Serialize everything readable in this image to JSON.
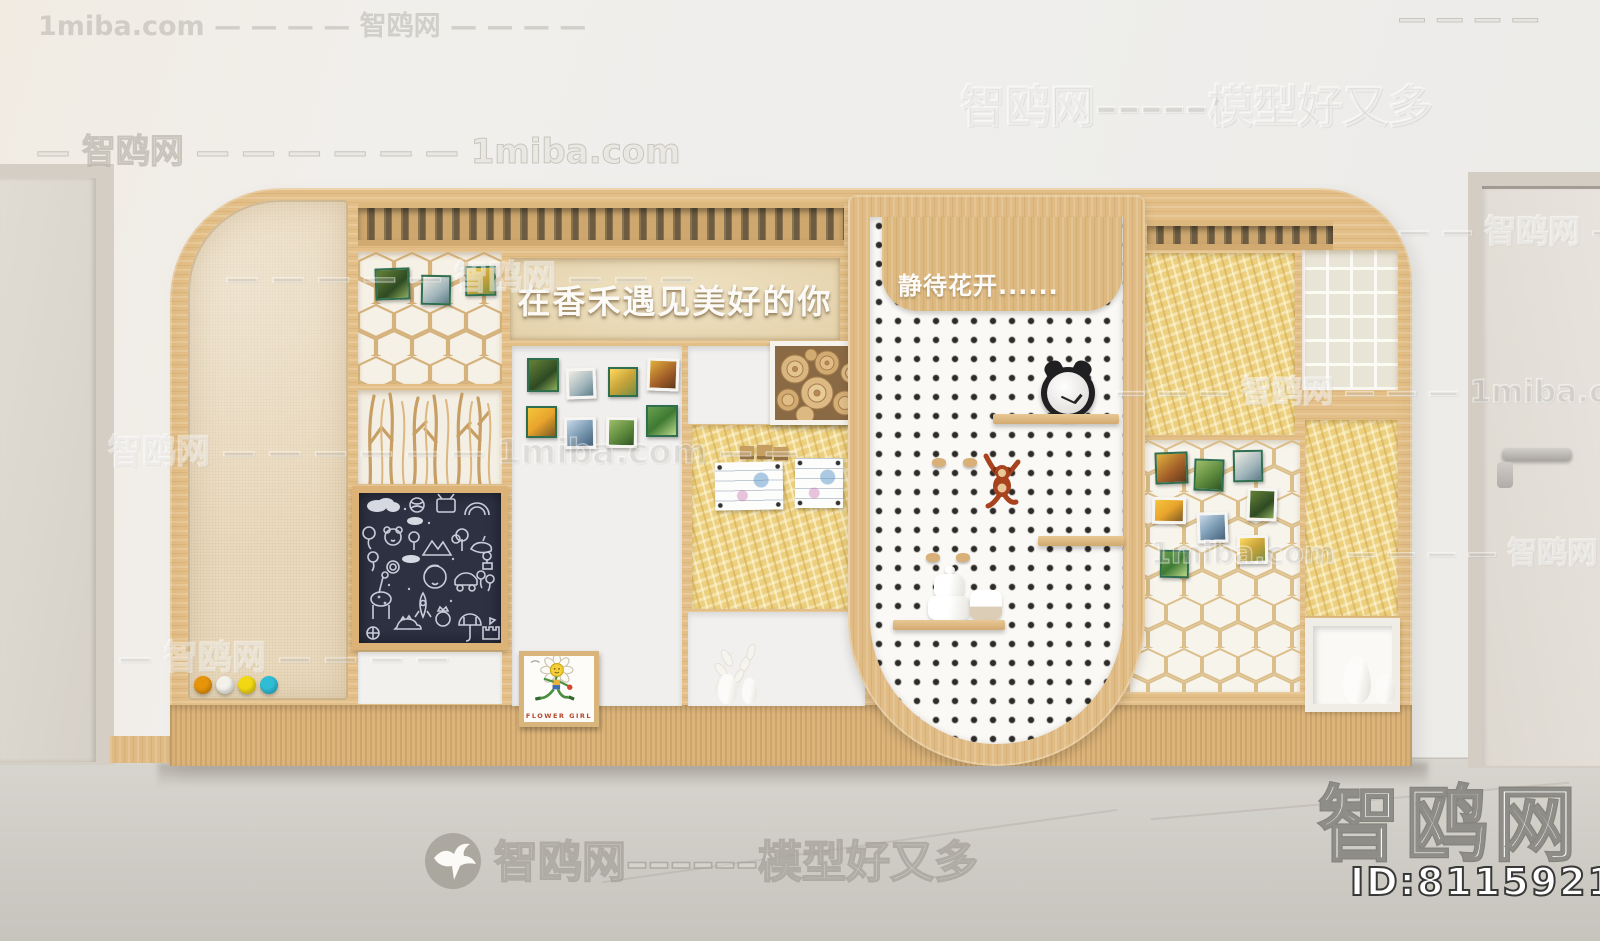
{
  "display": {
    "title": "在香禾遇见美好的你",
    "arch_caption": "静待花开......",
    "flower_girl_caption": "FLOWER GIRL"
  },
  "watermarks": {
    "brand_large": "智鸥网",
    "model_id": "ID:811592104",
    "rows": [
      "1miba.com — — — — 智鸥网 — — — —",
      "— — — —",
      "智鸥网–––––模型好又多",
      "— 智鸥网 — — — — — — 1miba.com",
      "— — — — — 智鸥网 — — —",
      "— — 智鸥网 —",
      "智鸥网 — — — — — — 1miba.com — —",
      "— — — 智鸥网 — — — 1miba.com",
      "1miba.com — — — — 智鸥网",
      "— 智鸥网 — — — —",
      "智鸥网––––––模型好又多"
    ]
  },
  "colors": {
    "wood": "#e3bf87",
    "osb": "#ecd07e",
    "blackboard": "#2d3142",
    "pegboard": "#fbf9f5",
    "pegboard_dot": "#2e2c2a",
    "fabric": "#e9d9bd",
    "floor": "#d0cdc7",
    "magnet_dots": [
      "#e8940a",
      "#f2f1ea",
      "#f2d813",
      "#2fbdd6"
    ]
  }
}
